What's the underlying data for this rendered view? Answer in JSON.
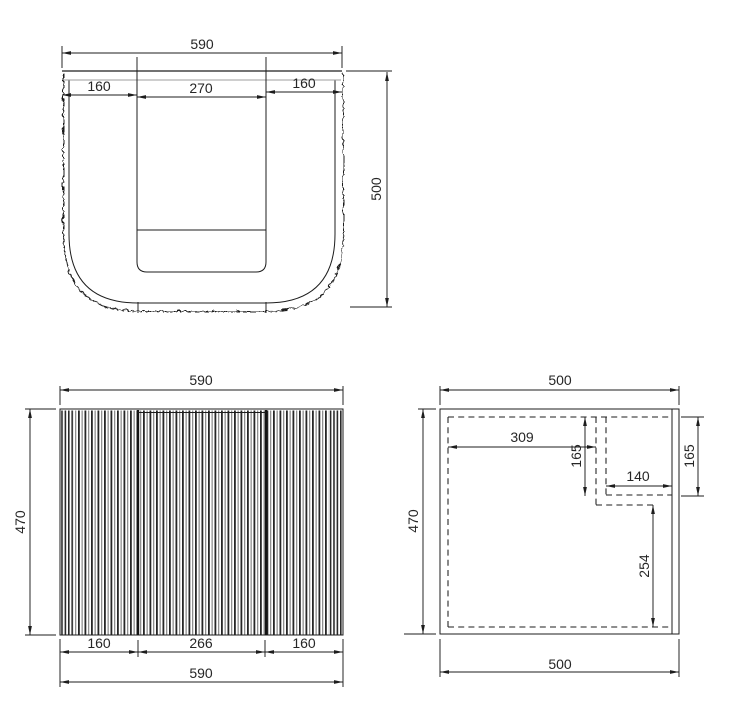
{
  "colors": {
    "line": "#1d1d1d",
    "gray_line": "#9d9d9d",
    "background": "#ffffff"
  },
  "views": {
    "top": {
      "label": "top view",
      "width": "590",
      "left": "160",
      "basin": "270",
      "right": "160",
      "depth": "500"
    },
    "front": {
      "label": "front view",
      "width_top": "590",
      "height": "470",
      "door_left": "160",
      "door_center": "266",
      "door_right": "160",
      "width_bottom": "590"
    },
    "side": {
      "label": "side view",
      "depth_top": "500",
      "height": "470",
      "cutout_offset": "309",
      "cutout_depth_left": "165",
      "cutout_width": "140",
      "cutout_depth_right": "165",
      "clearance": "254",
      "depth_bottom": "500"
    }
  }
}
